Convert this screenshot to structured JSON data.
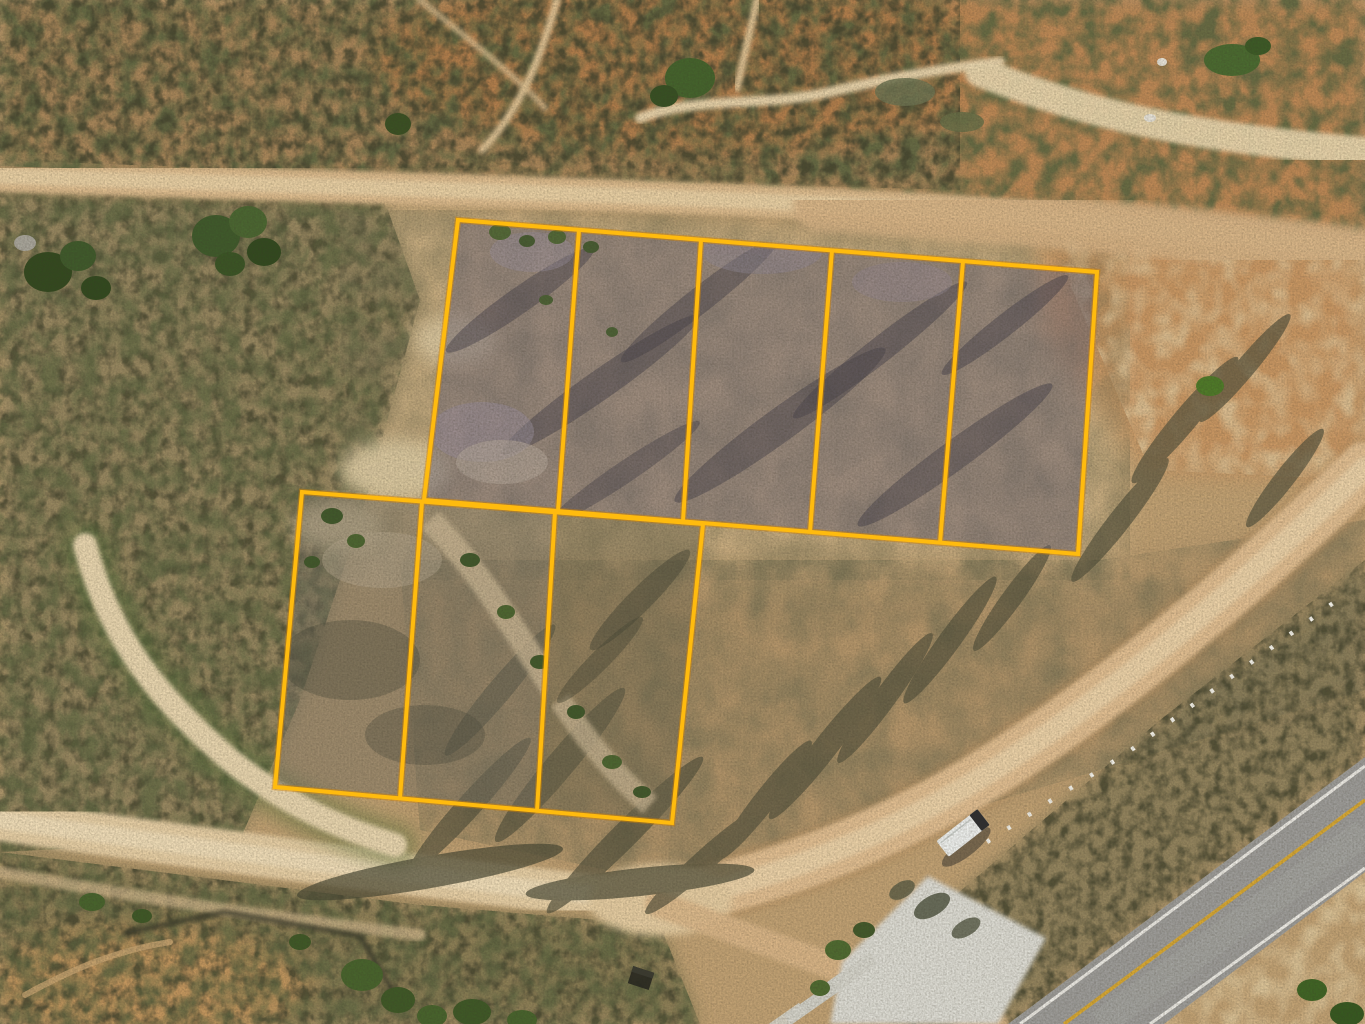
{
  "scene": {
    "kind": "aerial-drone-photograph",
    "subject": "Eight surveyed land lots outlined in yellow on desert scrubland beside a highway",
    "lot_count_total": 8,
    "lot_count_top_row": 5,
    "lot_count_bottom_row": 3
  },
  "colors": {
    "boundary": "#ffbb0e",
    "boundary_edge": "#d28200",
    "base_sand": "#c2a274",
    "field": "#cfb386",
    "sand_light": "#e8d2a8",
    "scrub": "#968758",
    "scrub_dark": "#4c4c38",
    "veg": "#4c6530",
    "veg_dark": "#3a5222",
    "soil_orange": "#c18a57",
    "burnt": "#6f6876",
    "burnt_olive": "#6f684f",
    "burnt_gray": "#777164",
    "dirt_road": "#ddbb8d",
    "dirt_road_core": "#e9d0a4",
    "paved": "#9d9c99",
    "lane_yellow": "#d8a832",
    "lane_white": "#edebe5",
    "concrete": "#dddcd4",
    "truck": "#eef0ee",
    "post": "#f4f2ea"
  },
  "parcels": {
    "line_width": 4,
    "top_group": {
      "lots": 5,
      "outline": "458,220 1097,272 1078,554 424,500",
      "dividers": [
        "579,230 558,511",
        "701,240 683,521",
        "832,250 810,532",
        "963,261 940,543"
      ]
    },
    "bottom_group": {
      "lots": 3,
      "outline": "302,492 703,524 672,823 275,787",
      "dividers": [
        "422,502 400,798",
        "555,512 537,811"
      ]
    }
  },
  "roads": {
    "dirt_top": {
      "d": "M0,176 C300,186 640,194 900,208 C1080,218 1250,236 1365,252",
      "width": 32
    },
    "dirt_top_right": {
      "d": "M820,205 C1000,215 1180,232 1365,255",
      "width": 54
    },
    "dirt_right": {
      "d": "M1365,468 C1240,588 1090,716 950,796 C850,852 748,886 658,902",
      "width": 52
    },
    "sand_bottom": {
      "d": "M0,820 C170,844 420,878 658,902",
      "width": 42
    },
    "spur": {
      "d": "M658,904 C770,944 880,984 995,1024",
      "width": 26
    },
    "paved": {
      "polygon": "1008,1024 1365,757 1365,872 1164,1024",
      "white_left": "1020,1024 1365,766",
      "yellow": "1064,1024 1365,800",
      "white_right": "1150,1024 1365,868"
    }
  },
  "objects": {
    "truck": {
      "transform": "translate(963,833) rotate(-38)"
    },
    "debris": {
      "transform": "translate(641,978) rotate(18)"
    },
    "marker_posts": {
      "points": "987,842 1047,803 1127,753 1227,680 1347,593"
    },
    "concrete_pads": {
      "outline": "928,876 1046,938 998,1024 830,1024 842,962"
    }
  }
}
